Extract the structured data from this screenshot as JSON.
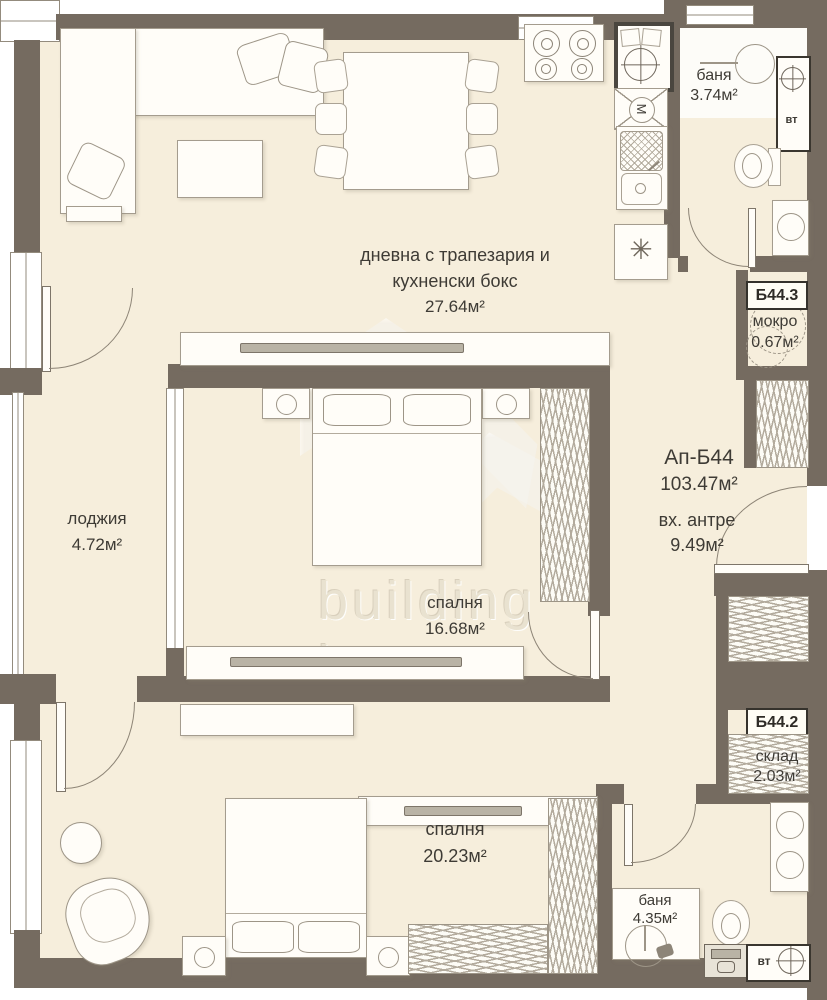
{
  "colors": {
    "wall": "#756b60",
    "floor": "#f6eedc",
    "line": "#a49c8e",
    "text": "#3e3b35",
    "watermark": "#e9e2d0"
  },
  "watermark": {
    "line1": "building",
    "line2": "box"
  },
  "apartment": {
    "id": "Ап-Б44",
    "area": "103.47м²"
  },
  "rooms": {
    "living": {
      "name_line1": "дневна с трапезария и",
      "name_line2": "кухненски бокс",
      "area": "27.64м²"
    },
    "bath1": {
      "name": "баня",
      "area": "3.74м²"
    },
    "mokro": {
      "badge": "Б44.3",
      "name": "мокро",
      "area": "0.67м²"
    },
    "entry": {
      "name": "вх. антре",
      "area": "9.49м²"
    },
    "loggia": {
      "name": "лоджия",
      "area": "4.72м²"
    },
    "bedroom1": {
      "name": "спалня",
      "area": "16.68м²"
    },
    "sklad": {
      "badge": "Б44.2",
      "name": "склад",
      "area": "2.03м²"
    },
    "bedroom2": {
      "name": "спалня",
      "area": "20.23м²"
    },
    "bath2": {
      "name": "баня",
      "area": "4.35м²"
    }
  },
  "shafts": {
    "top": "вт",
    "bottom": "вт"
  },
  "kitchen": {
    "boiler_label": "М",
    "fridge_symbol": "✳"
  }
}
